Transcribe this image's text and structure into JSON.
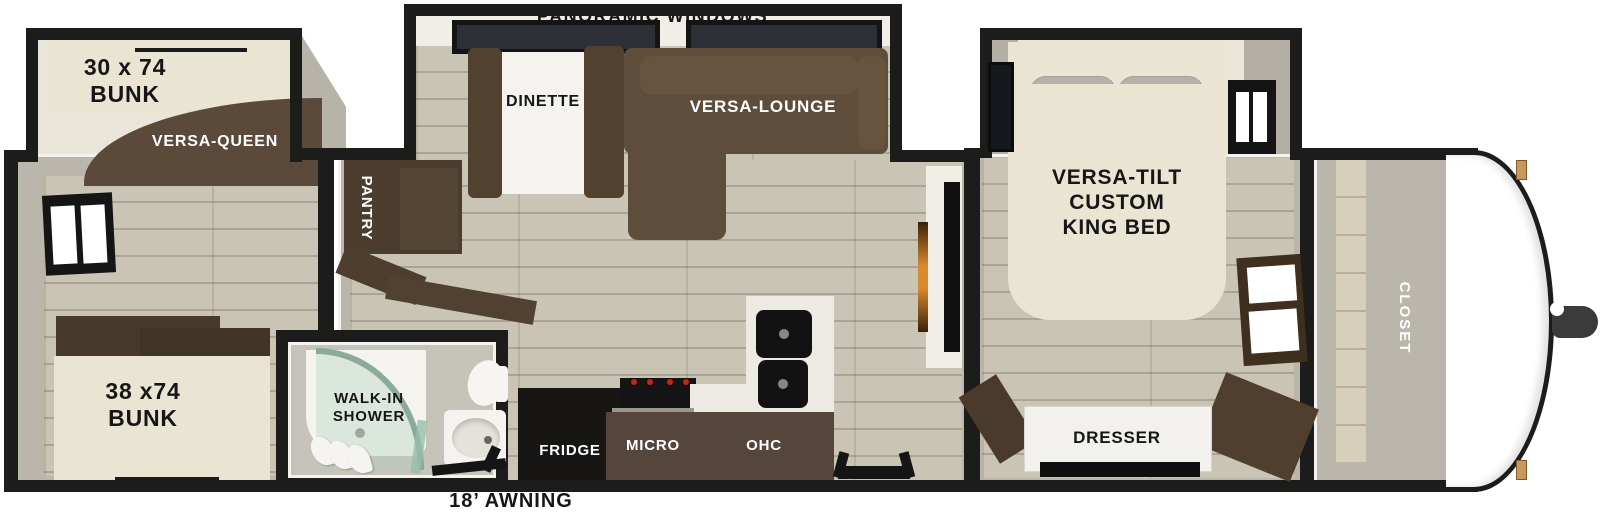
{
  "colors": {
    "wall": "#1c1c1a",
    "floor": "#c9c4b3",
    "wood_furniture": "#5e4d3b",
    "cream_mattress": "#e9e5d2",
    "shower_glass": "#a8c8b6",
    "fireplace_glow": "#d88a2f",
    "burner_red": "#cc2211"
  },
  "areas": {
    "rear_bunkroom": {
      "bunk_top": "30 x 74\nBUNK",
      "versa_queen": "VERSA-QUEEN",
      "bunk_bottom": "38 x74\nBUNK"
    },
    "living": {
      "panoramic_windows": "PANORAMIC WINDOWS",
      "dinette": "DINETTE",
      "versa_lounge": "VERSA-LOUNGE",
      "pantry": "PANTRY"
    },
    "kitchen": {
      "fridge": "FRIDGE",
      "micro": "MICRO",
      "ohc": "OHC"
    },
    "bathroom": {
      "walk_in_shower": "WALK-IN\nSHOWER"
    },
    "bedroom": {
      "king_bed": "VERSA-TILT\nCUSTOM\nKING BED",
      "dresser": "DRESSER"
    },
    "front": {
      "closet": "CLOSET"
    },
    "exterior": {
      "awning": "18’ AWNING"
    }
  }
}
